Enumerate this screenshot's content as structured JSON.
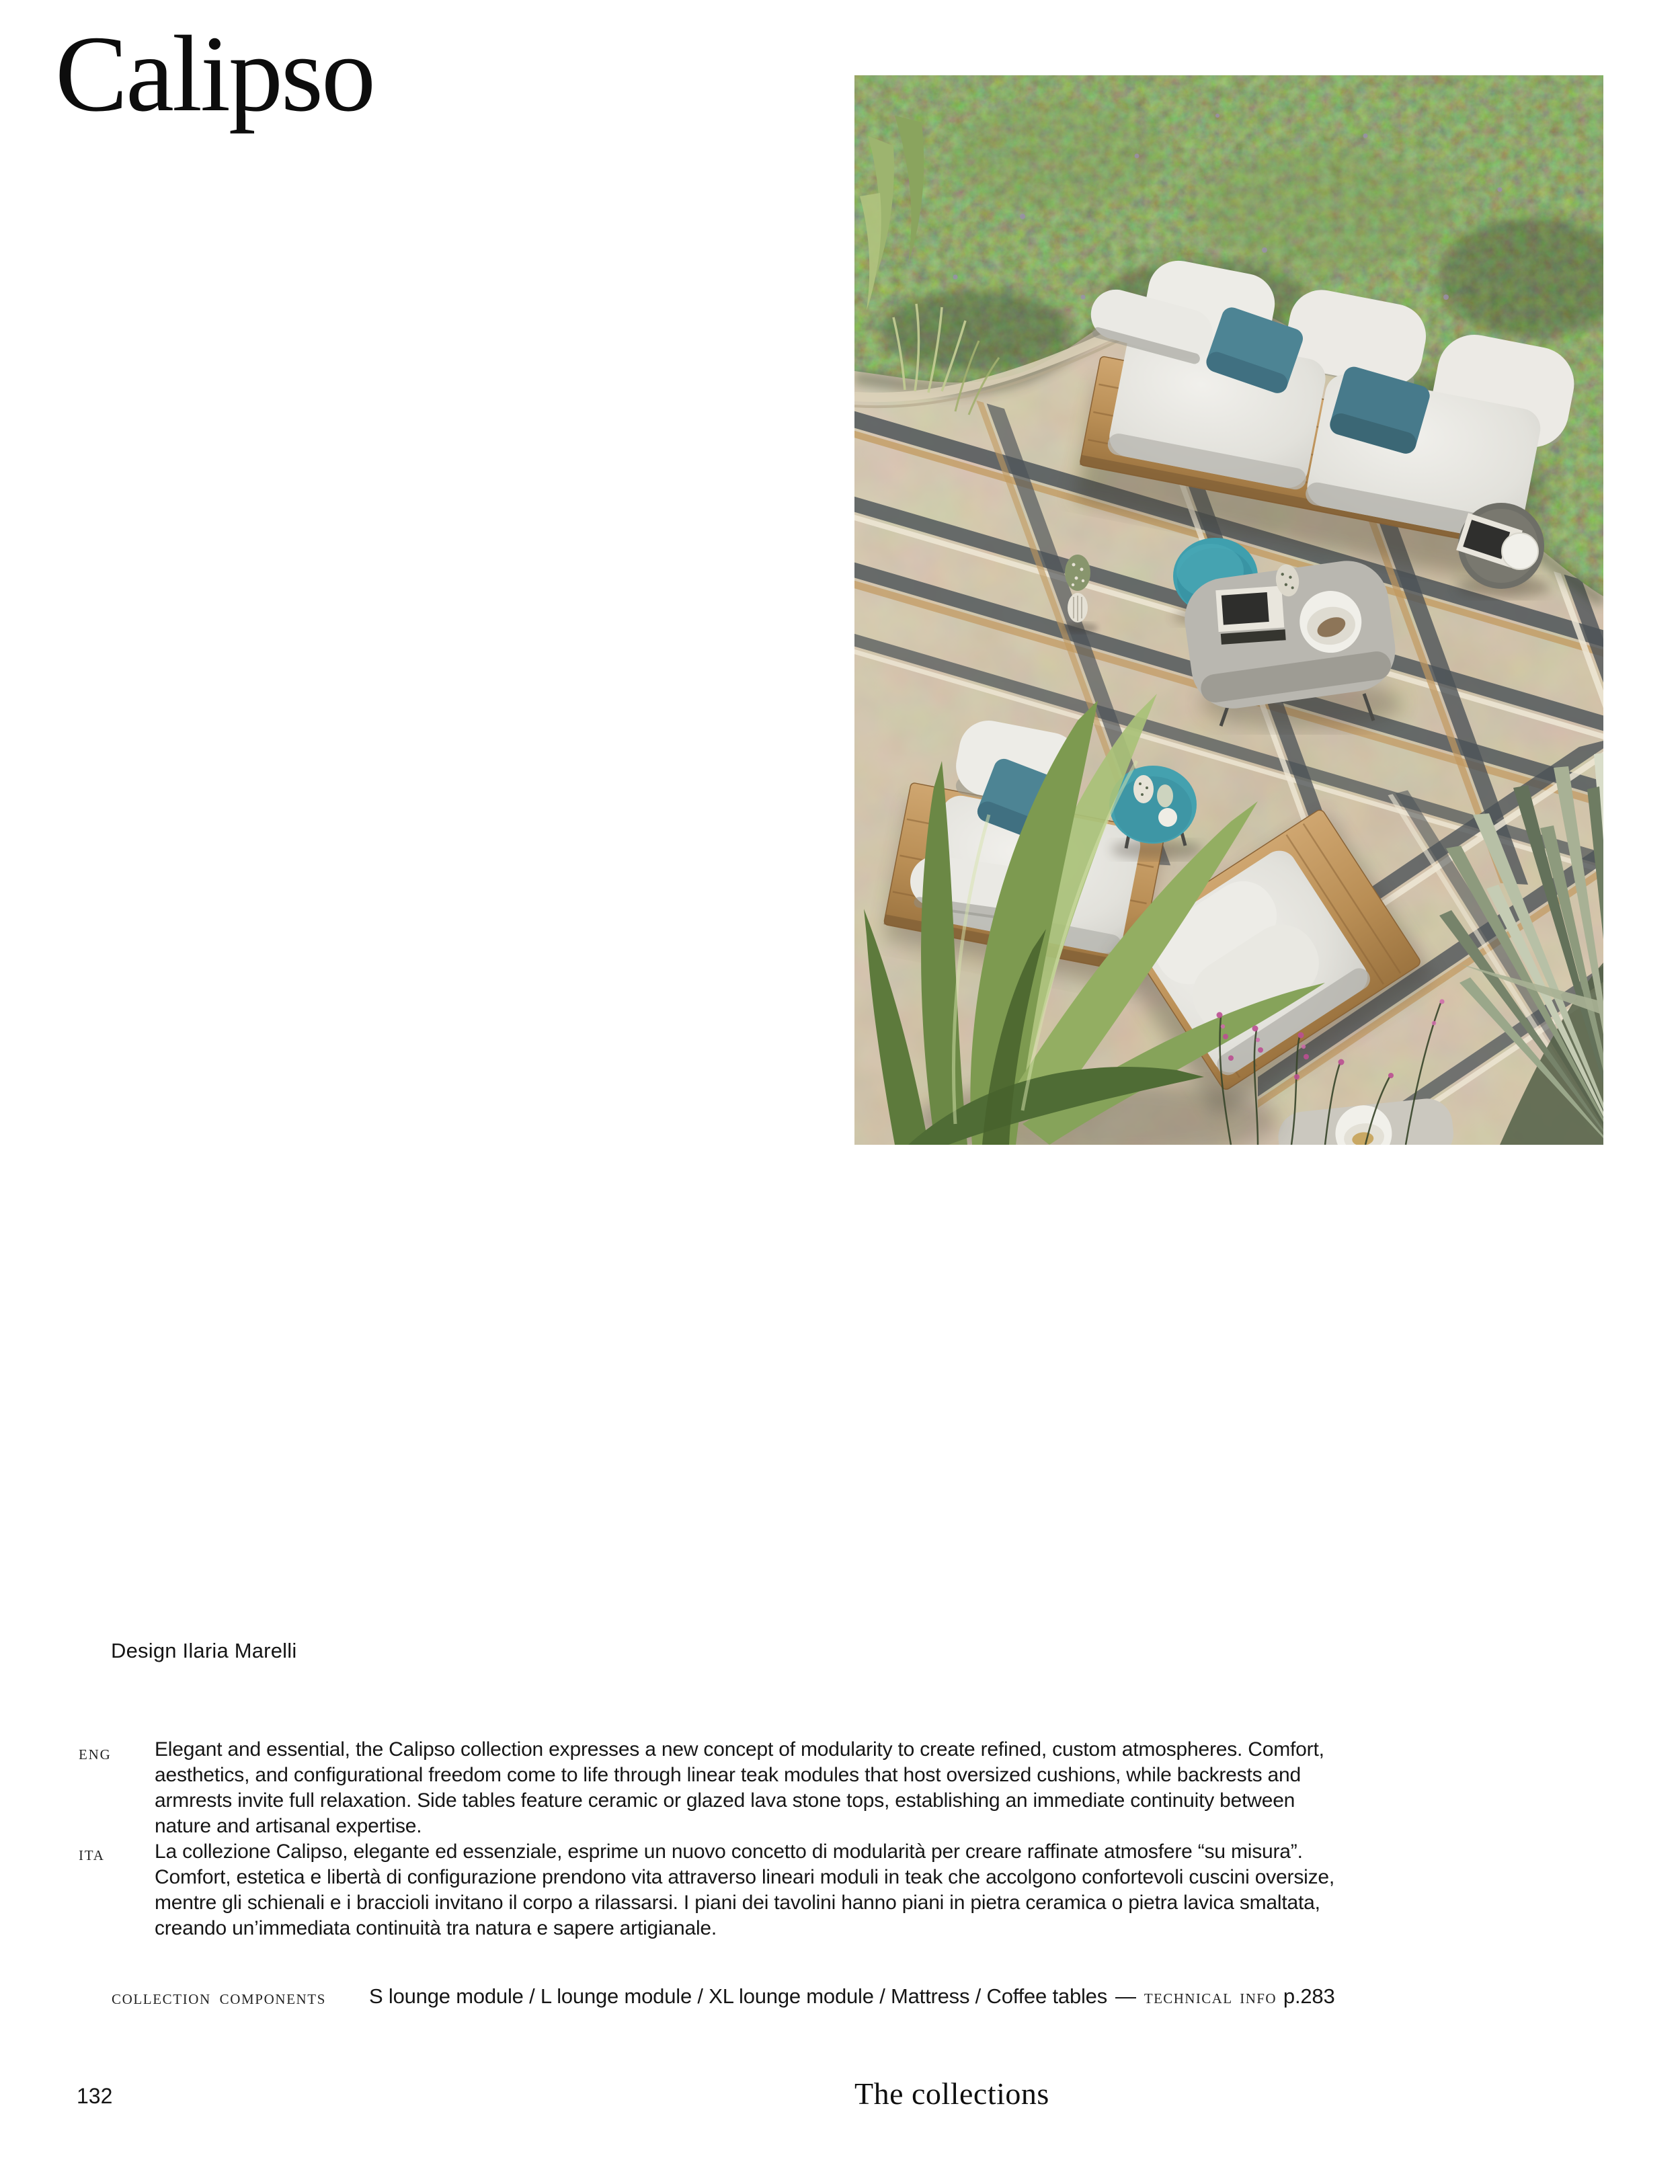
{
  "page": {
    "title": "Calipso",
    "designer": "Design Ilaria Marelli",
    "languages": [
      {
        "code": "ENG",
        "text": "Elegant and essential, the Calipso collection expresses a new concept of modularity to create refined, custom atmospheres. Comfort,\naesthetics, and configurational freedom come to life through linear teak modules that host oversized cushions, while backrests and\narmrests invite full relaxation. Side tables feature ceramic or glazed lava stone tops, establishing an immediate continuity between\nnature and artisanal expertise."
      },
      {
        "code": "ITA",
        "text": "La collezione Calipso, elegante ed essenziale, esprime un nuovo concetto di modularità per creare raffinate atmosfere “su misura”.\nComfort, estetica e libertà di configurazione prendono vita attraverso lineari moduli in teak che accolgono confortevoli cuscini oversize,\nmentre gli schienali e i braccioli invitano il corpo a rilassarsi. I piani dei tavolini hanno piani in pietra ceramica o pietra lavica smaltata,\ncreando un’immediata continuità tra natura e sapere artigianale."
      }
    ],
    "components": {
      "label": "COLLECTION COMPONENTS",
      "items": "S lounge module / L lounge module / XL lounge module / Mattress / Coffee tables",
      "separator": "—",
      "tech_label": "TECHNICAL INFO",
      "tech_page": "p.283"
    },
    "footer": {
      "page_number": "132",
      "section": "The collections"
    }
  },
  "photo": {
    "palette": {
      "hedge_green": "#5c7046",
      "stone_beige": "#c6b89e",
      "stripe_slate": "#4b5257",
      "teak_wood": "#b98e55",
      "cushion_white": "#e9e8e2",
      "accent_teal": "#3f9fae",
      "pillow_teal": "#4d8494"
    }
  }
}
